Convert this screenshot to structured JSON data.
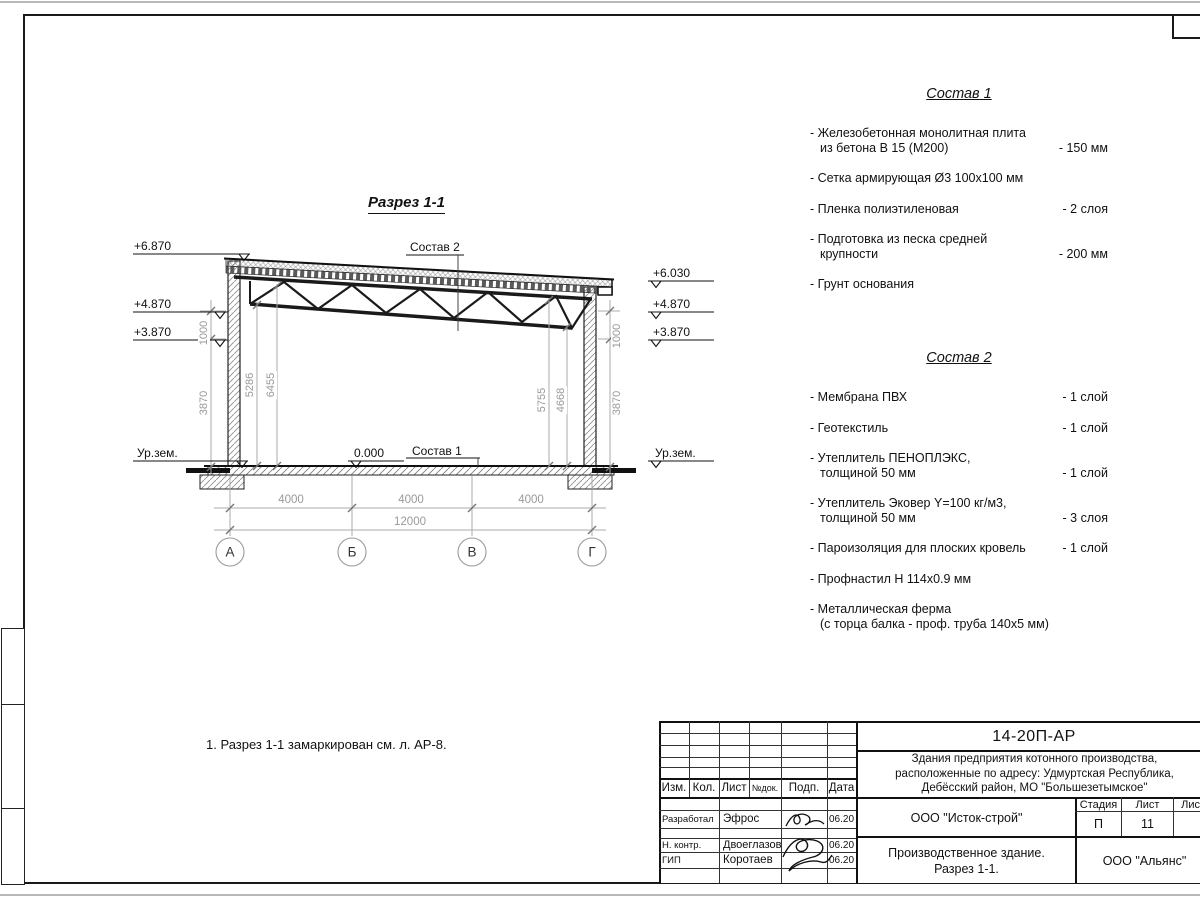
{
  "drawing": {
    "title": "Разрез 1-1",
    "label_sostav_2": "Состав 2",
    "label_sostav_1": "Состав 1",
    "zero_level": "0.000",
    "ground_left": "Ур.зем.",
    "ground_right": "Ур.зем.",
    "elev_left": [
      "+6.870",
      "+4.870",
      "+3.870"
    ],
    "elev_right": [
      "+6.030",
      "+4.870",
      "+3.870"
    ],
    "vdims": {
      "left_outer_upper": "1000",
      "left_outer_lower": "3870",
      "left_inner_near": "5286",
      "left_inner_far": "6455",
      "right_inner_far": "5755",
      "right_inner_near": "4668",
      "right_outer_upper": "1000",
      "right_outer_lower": "3870"
    },
    "hdims": [
      "4000",
      "4000",
      "4000"
    ],
    "total_dim": "12000",
    "axes": [
      "А",
      "Б",
      "В",
      "Г"
    ],
    "note": "1. Разрез 1-1 замаркирован см. л. АР-8."
  },
  "sostav1": {
    "title": "Состав 1",
    "items": [
      {
        "name": "- Железобетонная  монолитная плита\nиз бетона В 15 (М200)",
        "value": "- 150 мм"
      },
      {
        "name": "- Сетка армирующая Ø3 100х100 мм",
        "value": ""
      },
      {
        "name": "- Пленка полиэтиленовая",
        "value": "-  2 слоя"
      },
      {
        "name": "- Подготовка из песка средней\nкрупности",
        "value": "- 200 мм"
      },
      {
        "name": "- Грунт основания",
        "value": ""
      }
    ]
  },
  "sostav2": {
    "title": "Состав 2",
    "items": [
      {
        "name": "- Мембрана ПВХ",
        "value": "- 1 слой"
      },
      {
        "name": "- Геотекстиль",
        "value": "- 1 слой"
      },
      {
        "name": "- Утеплитель ПЕНОПЛЭКС,\nтолщиной 50 мм",
        "value": "- 1 слой"
      },
      {
        "name": "- Утеплитель Эковер Y=100 кг/м3,\nтолщиной 50 мм",
        "value": "- 3 слоя"
      },
      {
        "name": "- Пароизоляция для плоских кровель",
        "value": "- 1 слой"
      },
      {
        "name": "- Профнастил Н 114х0.9 мм",
        "value": ""
      },
      {
        "name": "- Металлическая ферма\n(с торца балка - проф. труба 140х5 мм)",
        "value": ""
      }
    ]
  },
  "titleblock": {
    "doc_number": "14-20П-АР",
    "project": "Здания предприятия котонного производства,\nрасположенные по адресу: Удмуртская Республика,\nДебёсский район, МО \"Большезетымское\"",
    "cols": [
      "Изм.",
      "Кол.",
      "Лист",
      "№док.",
      "Подп.",
      "Дата"
    ],
    "rows": [
      {
        "role": "Разработал",
        "name": "Эфрос",
        "date": "06.20"
      },
      {
        "role": "Н. контр.",
        "name": "Двоеглазов",
        "date": "06.20"
      },
      {
        "role": "ГИП",
        "name": "Коротаев",
        "date": "06.20"
      }
    ],
    "company": "ООО \"Исток-строй\"",
    "stage_label": "Стадия",
    "sheet_label": "Лист",
    "sheets_label": "Листов",
    "stage": "П",
    "sheet": "11",
    "object": "Производственное здание.\nРазрез 1-1.",
    "org": "ООО \"Альянс\""
  }
}
